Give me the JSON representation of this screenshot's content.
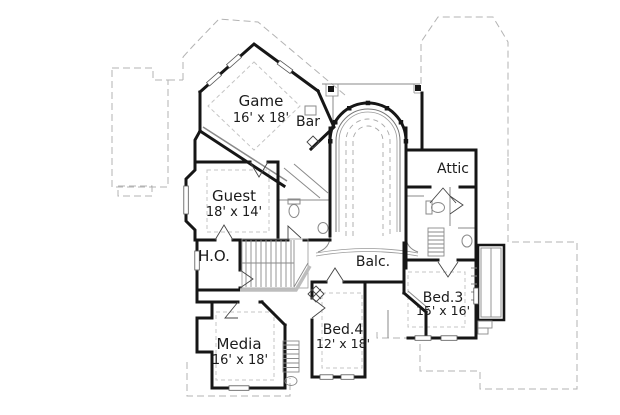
{
  "rooms": [
    {
      "key": "game",
      "name": "Game",
      "dims": "16' x 18'"
    },
    {
      "key": "bar",
      "name": "Bar",
      "dims": ""
    },
    {
      "key": "guest",
      "name": "Guest",
      "dims": "18' x 14'"
    },
    {
      "key": "attic",
      "name": "Attic",
      "dims": ""
    },
    {
      "key": "ho",
      "name": "H.O.",
      "dims": ""
    },
    {
      "key": "balcony",
      "name": "Balc.",
      "dims": ""
    },
    {
      "key": "bed3",
      "name": "Bed.3",
      "dims": "15' x 16'"
    },
    {
      "key": "bed4",
      "name": "Bed.4",
      "dims": "12' x 18'"
    },
    {
      "key": "media",
      "name": "Media",
      "dims": "16' x 18'"
    }
  ],
  "colors": {
    "wall": "#161616",
    "thin_line": "#8a8a8a",
    "dashed_line": "#b3b3b3",
    "text": "#1b1b1b",
    "background": "#ffffff"
  }
}
